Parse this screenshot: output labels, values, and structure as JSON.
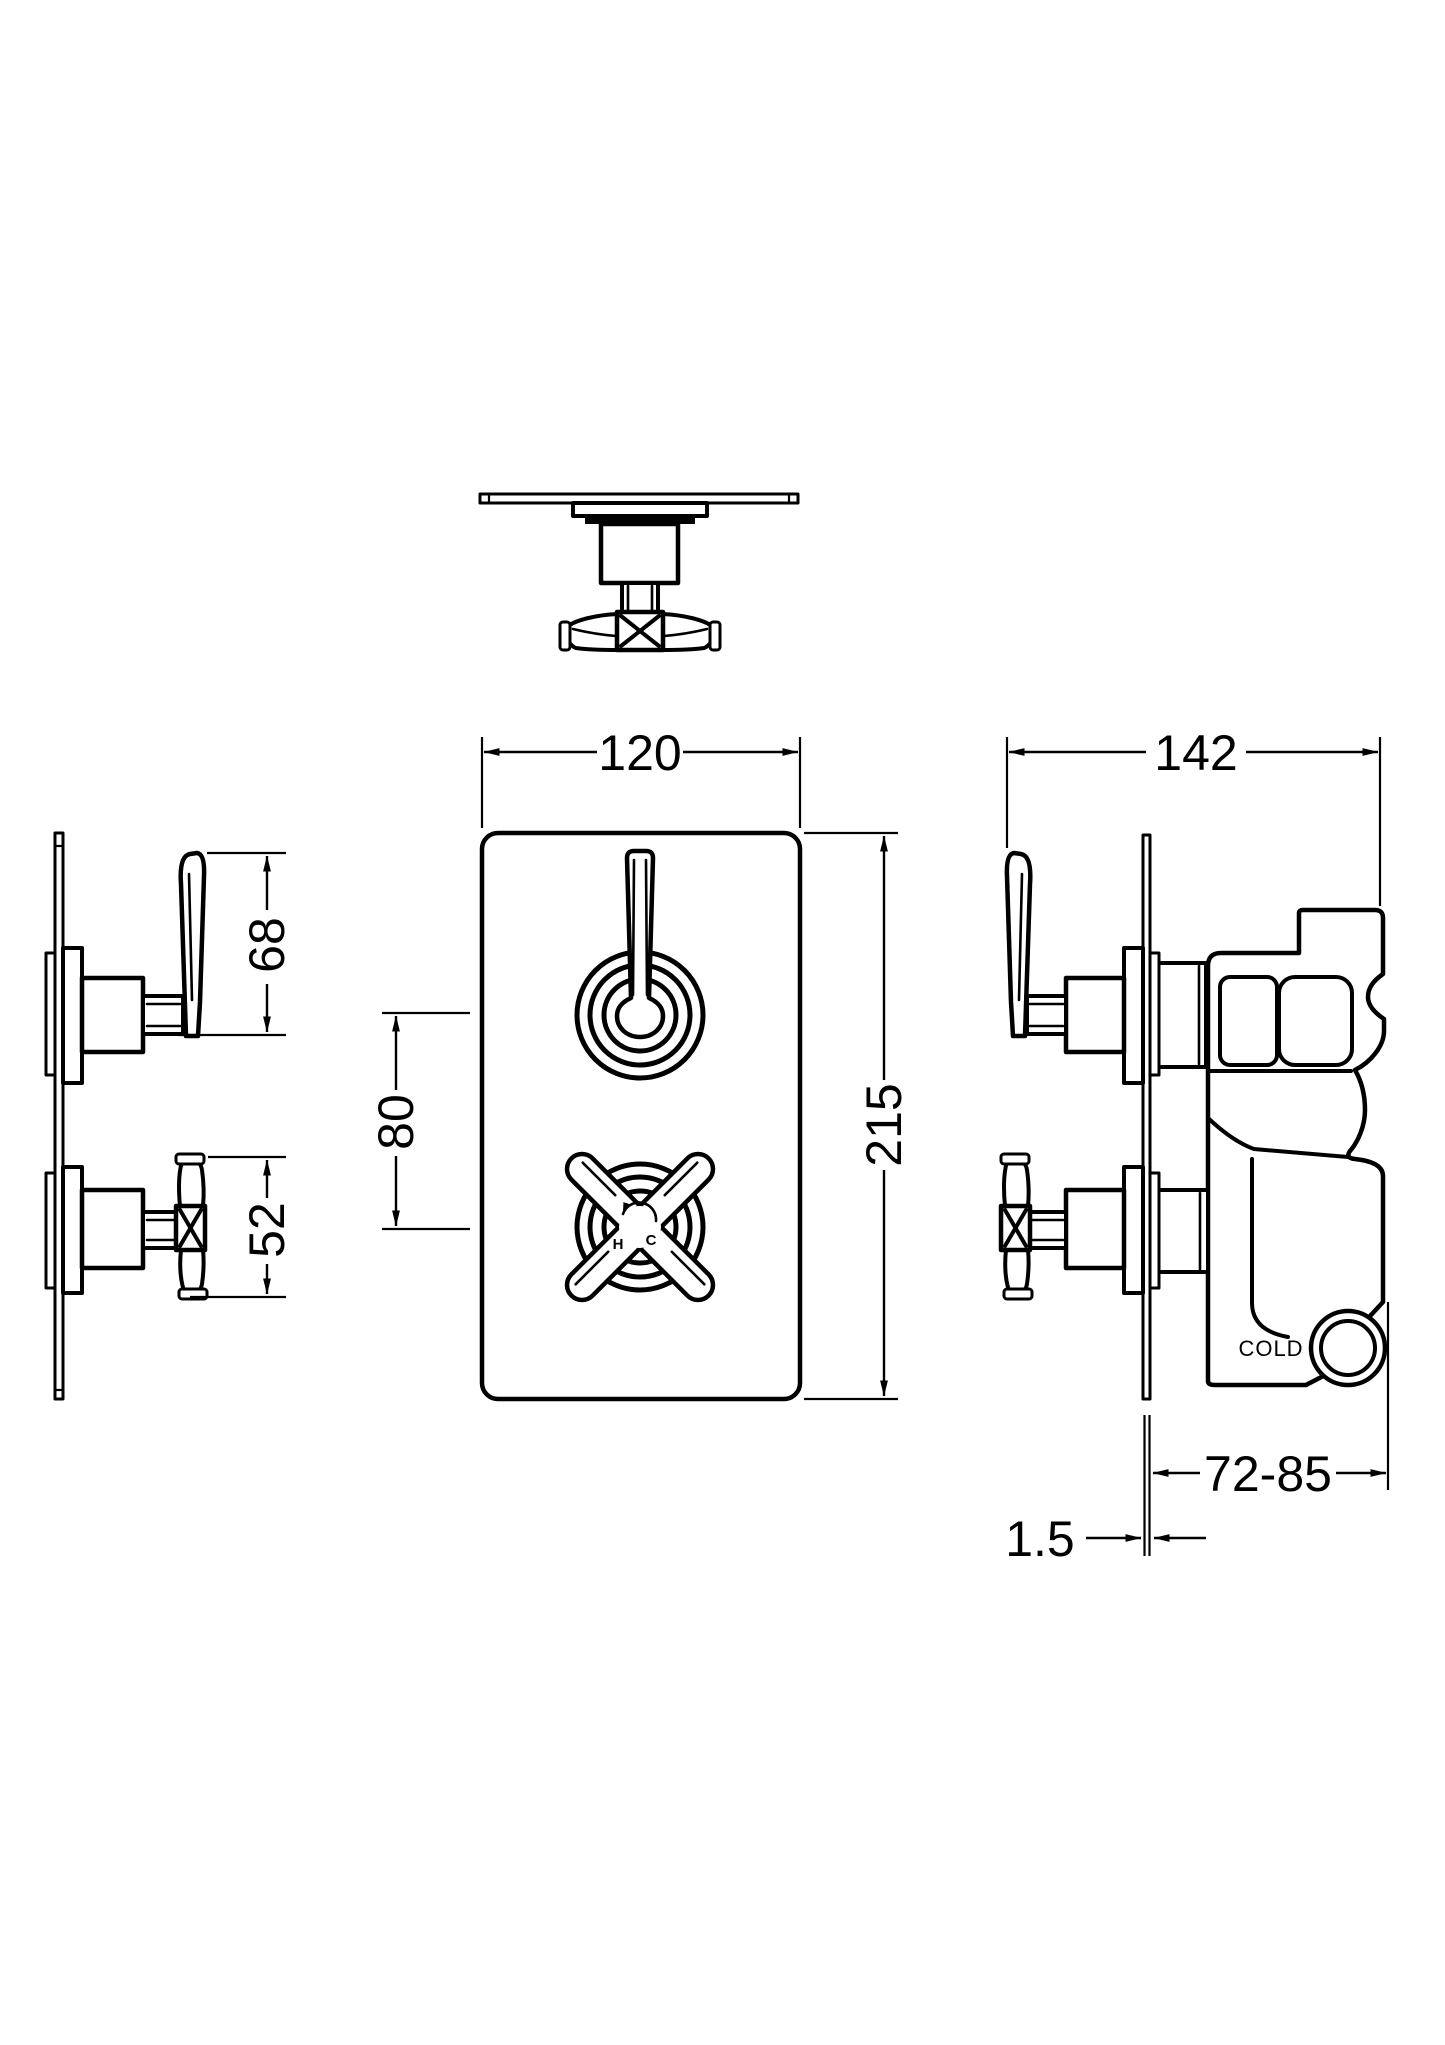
{
  "drawing": {
    "background_color": "#ffffff",
    "line_color": "#000000"
  },
  "dims": {
    "plate_width": "120",
    "plate_height": "215",
    "handle_centres": "80",
    "lever_projection": "68",
    "cross_projection": "52",
    "overall_depth": "142",
    "recess_depth": "72-85",
    "plate_thickness": "1.5"
  },
  "labels": {
    "cold_inlet": "COLD",
    "hot_mark": "H",
    "cold_mark": "C"
  }
}
